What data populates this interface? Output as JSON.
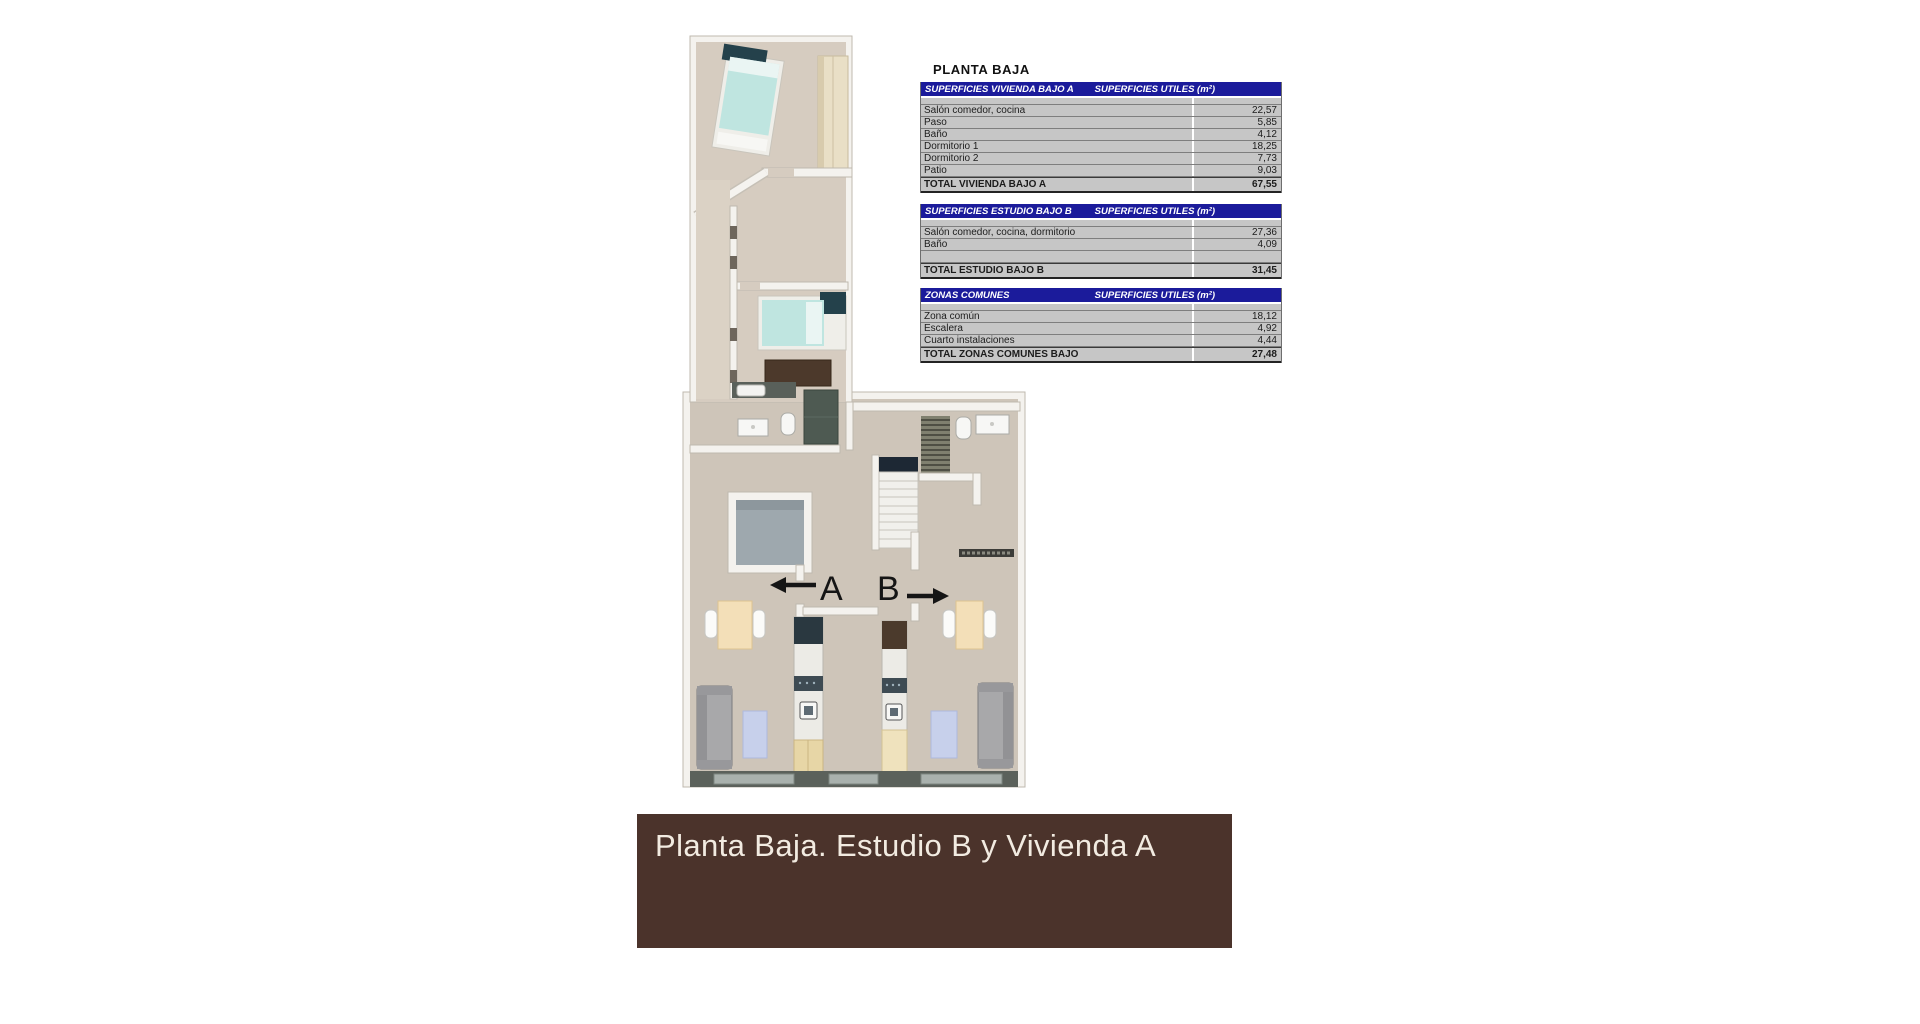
{
  "page": {
    "title": "PLANTA BAJA"
  },
  "tables": [
    {
      "header": "SUPERFICIES VIVIENDA BAJO A",
      "units": "SUPERFICIES UTILES  (m²)",
      "rows": [
        [
          "Salón comedor, cocina",
          "22,57"
        ],
        [
          "Paso",
          "5,85"
        ],
        [
          "Baño",
          "4,12"
        ],
        [
          "Dormitorio 1",
          "18,25"
        ],
        [
          "Dormitorio 2",
          "7,73"
        ],
        [
          "Patio",
          "9,03"
        ]
      ],
      "total_label": "TOTAL VIVIENDA BAJO A",
      "total_value": "67,55"
    },
    {
      "header": "SUPERFICIES ESTUDIO BAJO B",
      "units": "SUPERFICIES UTILES  (m²)",
      "rows": [
        [
          "Salón comedor, cocina, dormitorio",
          "27,36"
        ],
        [
          "Baño",
          "4,09"
        ],
        [
          "",
          ""
        ]
      ],
      "total_label": "TOTAL ESTUDIO BAJO B",
      "total_value": "31,45"
    },
    {
      "header": "ZONAS COMUNES",
      "units": "SUPERFICIES UTILES  (m²)",
      "rows": [
        [
          "Zona común",
          "18,12"
        ],
        [
          "Escalera",
          "4,92"
        ],
        [
          "Cuarto instalaciones",
          "4,44"
        ]
      ],
      "total_label": "TOTAL ZONAS COMUNES BAJO",
      "total_value": "27,48"
    }
  ],
  "floorplan": {
    "unit_a": "A",
    "unit_b": "B"
  },
  "banner": {
    "title": "Planta Baja. Estudio B y Vivienda A"
  },
  "colors": {
    "table_header_bg": "#1b1b9b",
    "table_row_bg": "#c6c6c6",
    "banner_bg": "#4b332b",
    "banner_text": "#f2ebe1",
    "floor_upper": "#d6ccc0",
    "floor_lower": "#cec5b9",
    "wall": "#f4f2ee",
    "bed_teal": "#bfe5e0",
    "patio": "#9ea8ae",
    "stair_landing": "#1d2834",
    "rug_blue": "#c7d0eb",
    "dark_cabinet": "#4c392b"
  }
}
